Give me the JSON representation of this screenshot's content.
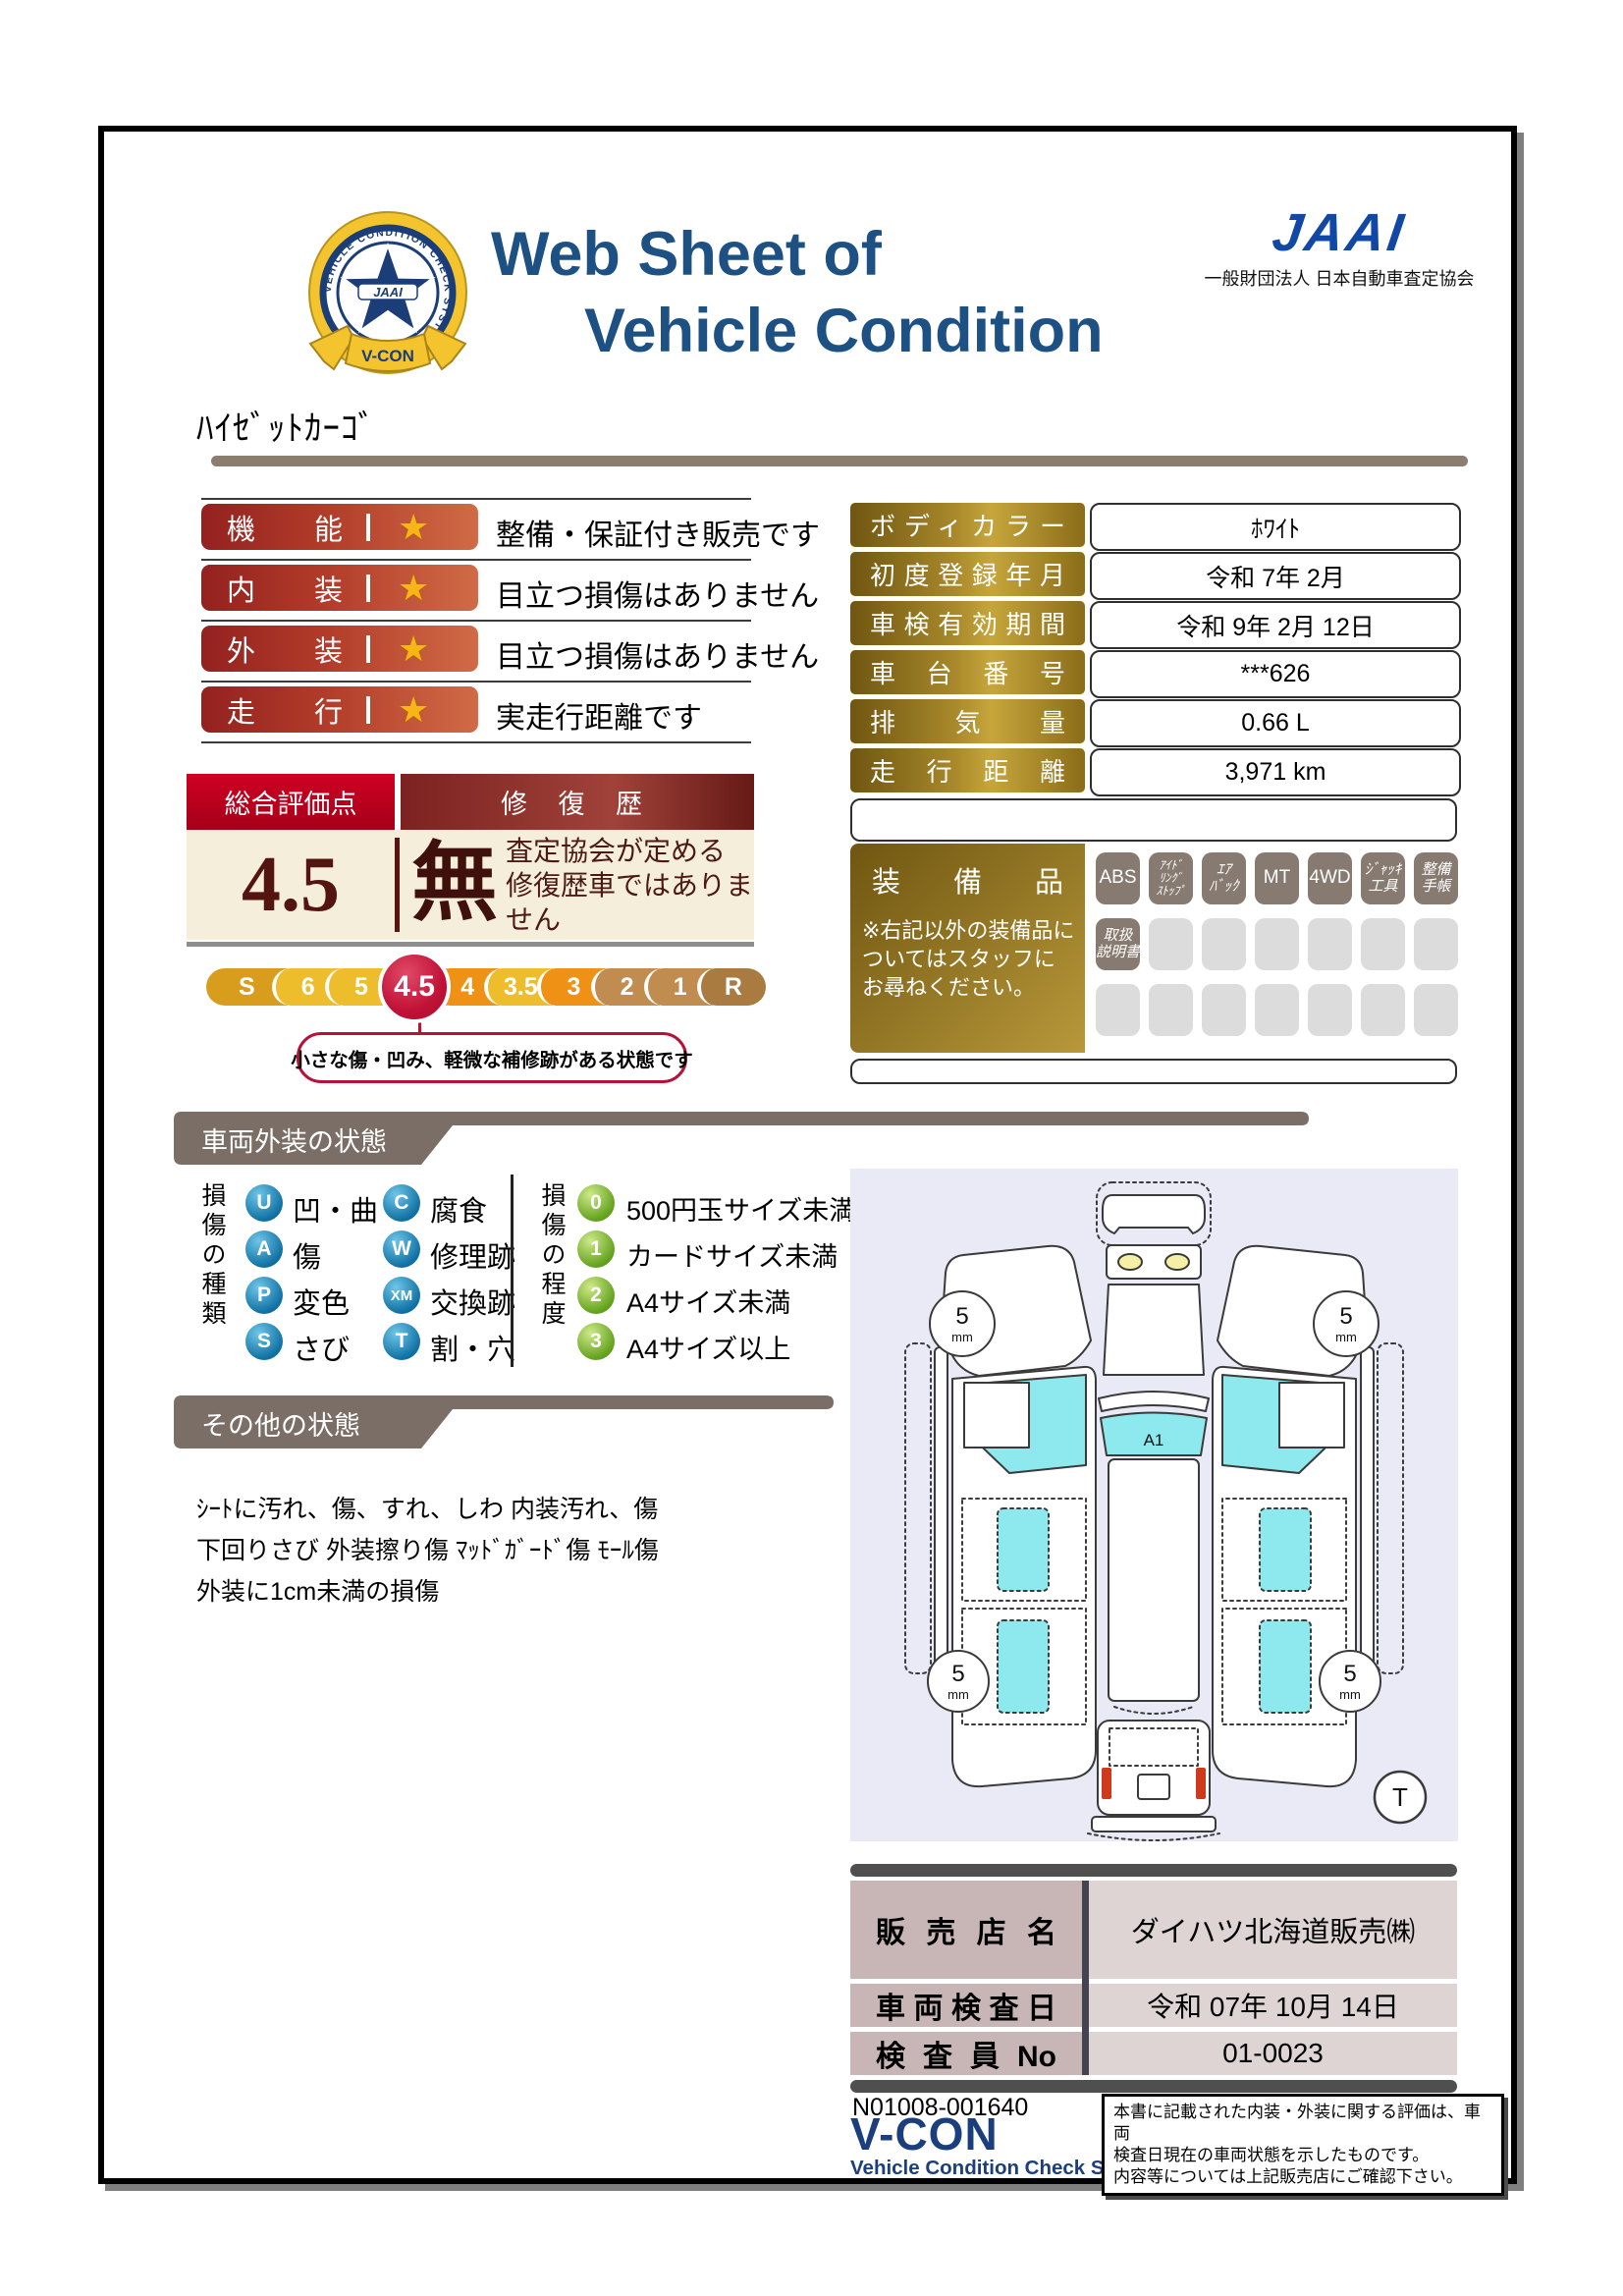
{
  "colors": {
    "title_navy": "#1d5184",
    "jaai_blue": "#1248a5",
    "rating_red_dark": "#93211f",
    "rating_red_light": "#d06b46",
    "star_gold": "#f7b616",
    "overall_header_red": "#cf0022",
    "overall_body_cream": "#f4eedb",
    "selected_grade_red": "#c11237",
    "gold_label": "#a9892b",
    "banner_gray": "#7b6e66",
    "diagram_bg": "#e9eaf6",
    "glass_cyan": "#8ee9ef",
    "dealer_label_pink": "#c8b5b5",
    "dealer_value_pink": "#ded4d4"
  },
  "header": {
    "title_line1": "Web Sheet of",
    "title_line2": "Vehicle Condition",
    "jaai_logo": "JAAI",
    "jaai_org": "一般財団法人 日本自動車査定協会",
    "badge_circle_text": "VEHICLE CONDITION CHECK SYSTEM",
    "badge_star_text": "JAAI",
    "badge_ribbon_text": "V-CON"
  },
  "vehicle_name": "ﾊｲｾﾞｯﾄｶｰｺﾞ",
  "ratings": {
    "star": "★",
    "items": [
      {
        "label": "機能",
        "description": "整備・保証付き販売です"
      },
      {
        "label": "内装",
        "description": "目立つ損傷はありません"
      },
      {
        "label": "外装",
        "description": "目立つ損傷はありません"
      },
      {
        "label": "走行",
        "description": "実走行距離です"
      }
    ]
  },
  "overall": {
    "score_label": "総合評価点",
    "score": "4.5",
    "repair_label": "修 復 歴",
    "repair_value": "無",
    "repair_note": "査定協会が定める\n修復歴車ではありません",
    "scale": [
      "S",
      "6",
      "5",
      "4.5",
      "4",
      "3.5",
      "3",
      "2",
      "1",
      "R"
    ],
    "selected_grade": "4.5",
    "callout": "小さな傷・凹み、軽微な補修跡がある状態です"
  },
  "info_table": {
    "rows": [
      {
        "label": "ボディカラー",
        "value": "ﾎﾜｲﾄ"
      },
      {
        "label": "初度登録年月",
        "value": "令和 7年 2月"
      },
      {
        "label": "車検有効期間",
        "value": "令和 9年 2月 12日"
      },
      {
        "label": "車台番号",
        "value": "***626"
      },
      {
        "label": "排気量",
        "value": "0.66 L"
      },
      {
        "label": "走行距離",
        "value": "3,971 km"
      }
    ]
  },
  "equipment": {
    "label": "装備品",
    "note": "※右記以外の装備品に\nついてはスタッフに\nお尋ねください。",
    "row1": [
      "ABS",
      "ｱｲﾄﾞ\nﾘﾝｸﾞ\nｽﾄｯﾌﾟ",
      "ｴｱ\nﾊﾞｯｸ",
      "MT",
      "4WD",
      "ｼﾞｬｯｷ\n工具",
      "整備\n手帳"
    ],
    "row2_first": "取扱\n説明書"
  },
  "exterior": {
    "banner": "車両外装の状態",
    "type_title": "損傷の種類",
    "types": [
      {
        "code": "U",
        "label": "凹・曲"
      },
      {
        "code": "A",
        "label": "傷"
      },
      {
        "code": "P",
        "label": "変色"
      },
      {
        "code": "S",
        "label": "さび"
      },
      {
        "code": "C",
        "label": "腐食"
      },
      {
        "code": "W",
        "label": "修理跡"
      },
      {
        "code": "XM",
        "label": "交換跡"
      },
      {
        "code": "T",
        "label": "割・穴"
      }
    ],
    "degree_title": "損傷の程度",
    "degrees": [
      {
        "code": "0",
        "label": "500円玉サイズ未満"
      },
      {
        "code": "1",
        "label": "カードサイズ未満"
      },
      {
        "code": "2",
        "label": "A4サイズ未満"
      },
      {
        "code": "3",
        "label": "A4サイズ以上"
      }
    ]
  },
  "other": {
    "banner": "その他の状態",
    "text": "ｼｰﾄに汚れ、傷、すれ、しわ 内装汚れ、傷\n下回りさび 外装擦り傷 ﾏｯﾄﾞｶﾞｰﾄﾞ傷 ﾓｰﾙ傷\n外装に1cm未満の損傷"
  },
  "diagram": {
    "windshield_mark": "A1",
    "tread_value": "5",
    "tread_unit": "mm",
    "tire_mark": "T"
  },
  "dealer": {
    "rows": [
      {
        "label": "販売店名",
        "value": "ダイハツ北海道販売㈱"
      },
      {
        "label": "車両検査日",
        "value": "令和 07年 10月 14日"
      },
      {
        "label": "検査員No",
        "value": "01-0023"
      }
    ]
  },
  "footer": {
    "serial": "N01008-001640",
    "vcon": "V-CON",
    "vcon_sub": "Vehicle Condition Check System",
    "note": "本書に記載された内装・外装に関する評価は、車両\n検査日現在の車両状態を示したものです。\n内容等については上記販売店にご確認下さい。"
  }
}
